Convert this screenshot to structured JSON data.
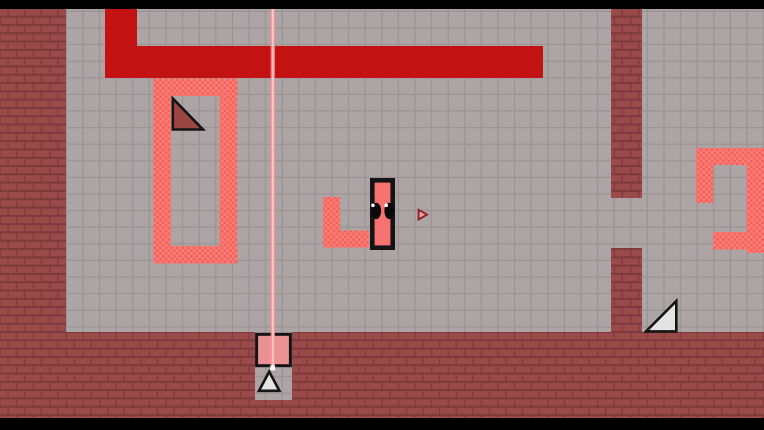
{
  "app": {
    "kind": "game-screenshot",
    "name": "2d-platformer-level"
  },
  "scene": {
    "rooms": [
      "main-tiled-room",
      "right-passage-room"
    ],
    "entities": [
      {
        "name": "player-character",
        "desc": "tall pink rectangle with two black eyes"
      },
      {
        "name": "laser-beam",
        "desc": "vertical pink beam from ceiling down to pink block"
      },
      {
        "name": "dart-projectile",
        "desc": "small red arrow right of player"
      },
      {
        "name": "red-pipe",
        "desc": "solid red L-shaped block hanging from ceiling"
      },
      {
        "name": "hazard-ring",
        "desc": "rectangular ring of dotted pink hazard tiles"
      },
      {
        "name": "hazard-l-block",
        "desc": "L-shaped dotted pink hazard beside player"
      },
      {
        "name": "hazard-hook",
        "desc": "hook-shaped dotted pink hazard at right screen edge"
      },
      {
        "name": "ramp-triangle-dark",
        "desc": "dark red wedge inside hazard ring"
      },
      {
        "name": "ramp-triangle-white",
        "desc": "white wedge on floor at bottom right"
      },
      {
        "name": "pink-block",
        "desc": "pink square block sitting in floor alcove under laser"
      },
      {
        "name": "spike-triangle",
        "desc": "white spike inside floor alcove"
      },
      {
        "name": "passage-gap",
        "desc": "gap opening in right brick pillar"
      }
    ],
    "colors": {
      "letterbox": "#000000",
      "brick": "#9B4A4A",
      "brick_mortar": "#7D3A3A",
      "tile": "#ADA5A5",
      "tile_line": "#9B9292",
      "red_block": "#C31212",
      "hazard_base": "#FC7F77",
      "hazard_dot": "#F2615A",
      "player_fill": "#F87272",
      "outline": "#141414",
      "eye": "#0A0A0A",
      "eye_glint": "#FFFFFF",
      "laser_beam": "#FF9494",
      "laser_core": "#FFC9C9",
      "laser_dot": "#FFFFFF",
      "pink_block": "#F49090",
      "spike_light": "#E4E4E4",
      "spike_dark": "#9B4545",
      "dart_outline": "#8E1F1F",
      "dart_fill": "#E9A0A0"
    }
  }
}
